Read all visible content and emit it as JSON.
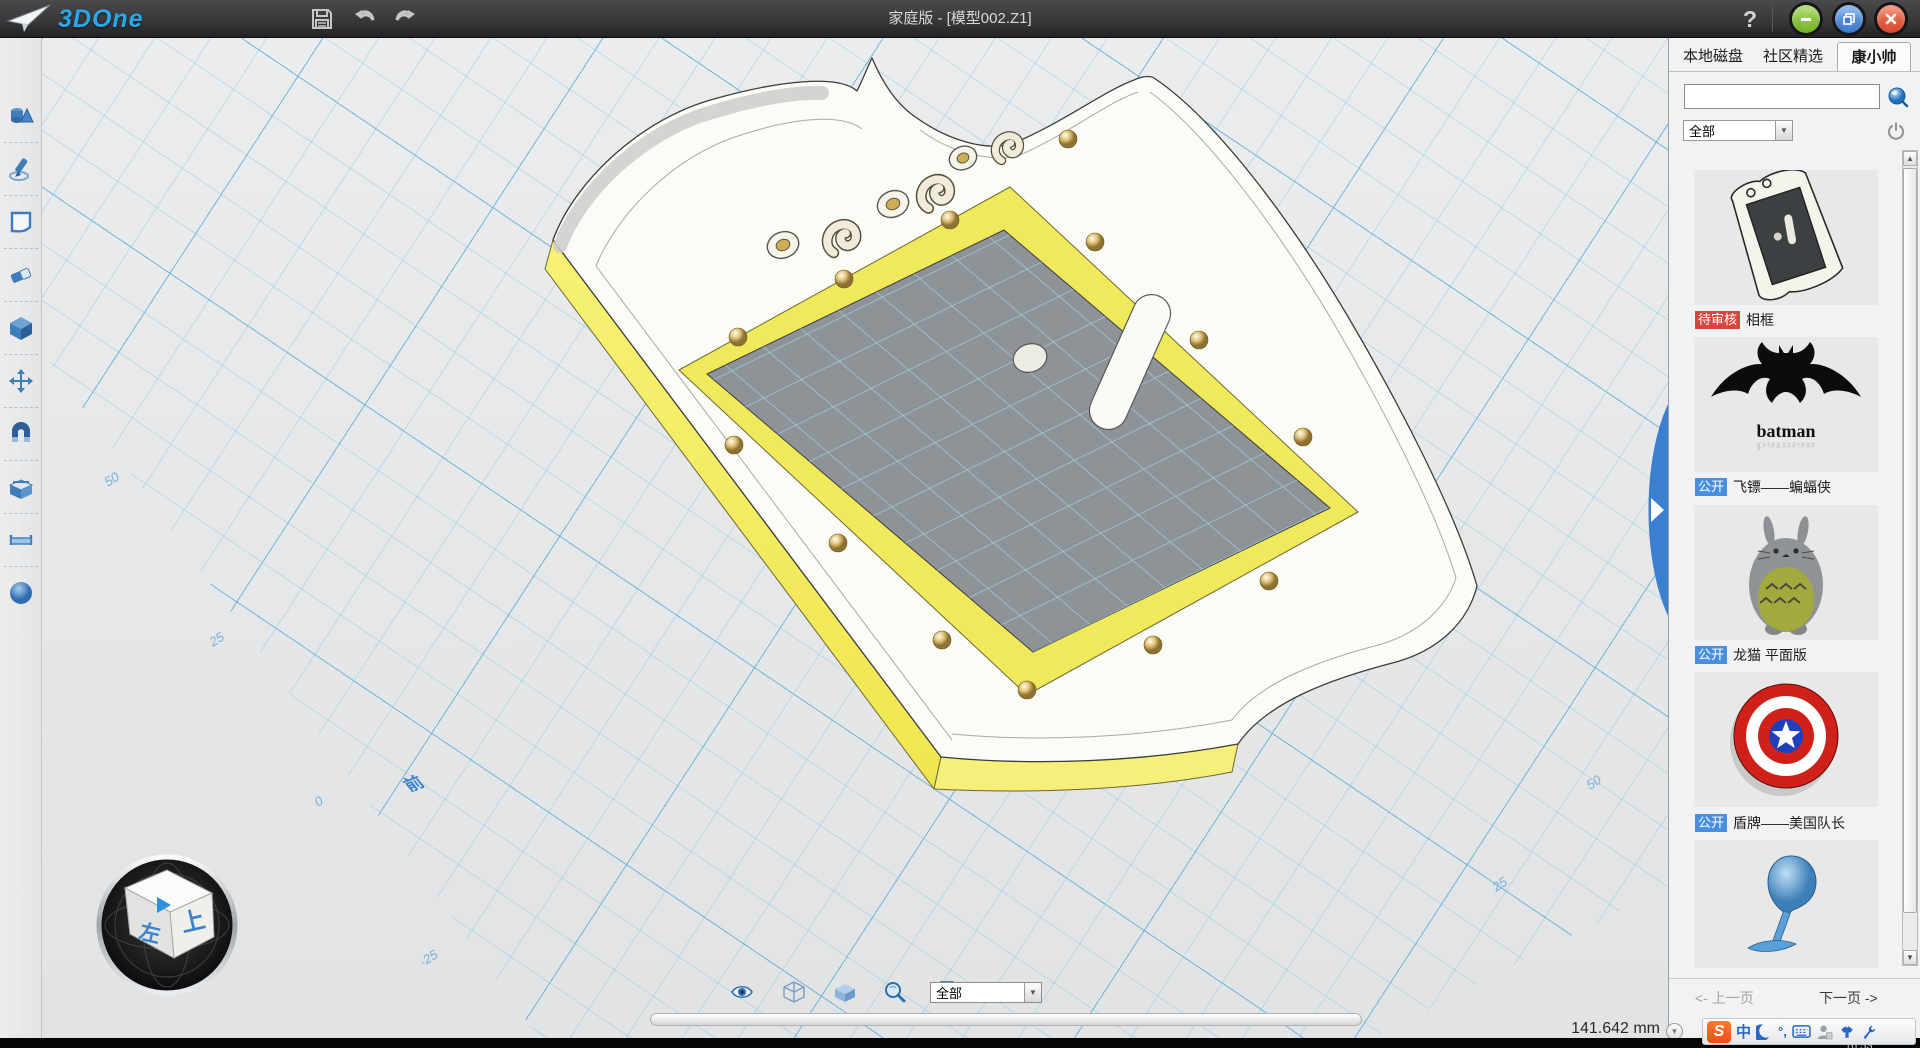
{
  "titlebar": {
    "brand": "3DOne",
    "title": "家庭版 - [模型002.Z1]",
    "help_label": "?",
    "icons": [
      "paper-plane-icon",
      "save-icon",
      "undo-icon",
      "redo-icon",
      "help-icon",
      "minimize-icon",
      "restore-icon",
      "close-icon"
    ]
  },
  "sidebar": {
    "tools": [
      {
        "icon": "primitives-icon"
      },
      {
        "icon": "sketch-pen-icon"
      },
      {
        "icon": "sketch-plane-icon"
      },
      {
        "icon": "eraser-icon"
      },
      {
        "icon": "solid-cube-icon"
      },
      {
        "icon": "move-icon"
      },
      {
        "icon": "magnet-snap-icon"
      },
      {
        "icon": "combine-box-icon"
      },
      {
        "icon": "measure-icon"
      },
      {
        "icon": "material-sphere-icon"
      }
    ]
  },
  "viewport": {
    "grid_labels_left": [
      "50",
      "25",
      "0",
      "-25"
    ],
    "grid_labels_right": [
      "25",
      "50"
    ],
    "view_cube": {
      "top": "前",
      "left": "左",
      "right": "上"
    },
    "measurement": "141.642 mm"
  },
  "display_toolbar": {
    "icons": [
      "eye-icon",
      "wireframe-cube-icon",
      "shaded-cube-icon",
      "zoom-icon",
      "print-icon"
    ],
    "filter_value": "全部"
  },
  "right_panel": {
    "tabs": [
      {
        "label": "本地磁盘"
      },
      {
        "label": "社区精选"
      },
      {
        "label": "康小帅",
        "active": true
      }
    ],
    "search": {
      "value": "",
      "placeholder": ""
    },
    "category_filter": "全部",
    "items": [
      {
        "badge": "待审核",
        "badge_color": "#d8453c",
        "label": "相框"
      },
      {
        "badge": "公开",
        "badge_color": "#4a8fdd",
        "label": "飞镖——蝙蝠侠",
        "thumb_caption": "batman"
      },
      {
        "badge": "公开",
        "badge_color": "#4a8fdd",
        "label": "龙猫 平面版"
      },
      {
        "badge": "公开",
        "badge_color": "#4a8fdd",
        "label": "盾牌——美国队长"
      },
      {
        "badge": "",
        "label": ""
      }
    ],
    "pagination": {
      "prev": "<- 上一页",
      "next": "下一页 ->"
    }
  },
  "ime_bar": {
    "logo": "S",
    "mode": "中",
    "punct": "°,",
    "icons": [
      "sogou-logo",
      "chinese-mode-icon",
      "moon-icon",
      "punctuation-icon",
      "keyboard-icon",
      "person-icon",
      "skin-icon",
      "wrench-icon"
    ]
  },
  "taskbar": {
    "clock": "16:53"
  },
  "colors": {
    "accent_blue": "#2aa7e8",
    "model_yellow": "#f3ec62",
    "glass_gray": "#8e9398",
    "grid_blue": "#80c6e8"
  }
}
